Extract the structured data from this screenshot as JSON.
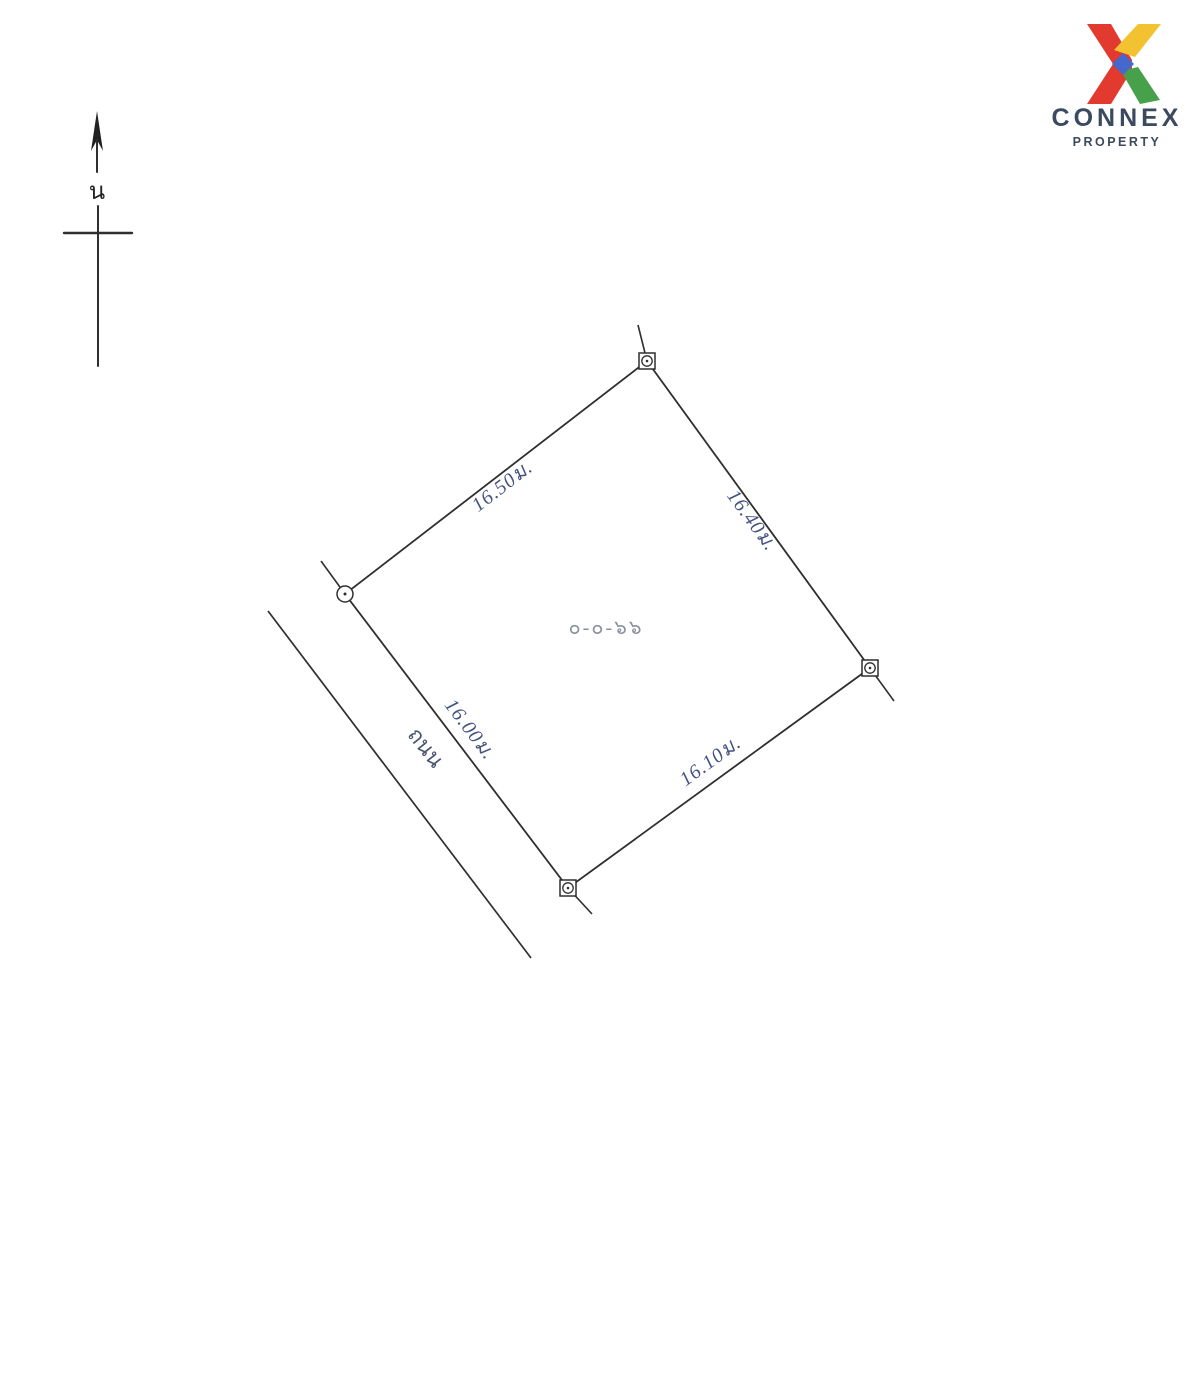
{
  "logo": {
    "brand": "CONNEX",
    "tagline": "PROPERTY",
    "colors": {
      "red": "#e23a2e",
      "yellow": "#f2c230",
      "green": "#47a14b",
      "blue": "#4468cc",
      "text": "#3b4a5e"
    }
  },
  "compass": {
    "north_label": "น"
  },
  "survey": {
    "area_label": "๐-๐-๖๖",
    "road_label": "ถนน",
    "dimensions": {
      "northwest": "16.50ม.",
      "northeast": "16.40ม.",
      "southwest": "16.00ม.",
      "southeast": "16.10ม."
    },
    "dimension_color": "#455380",
    "area_color": "#8a8fa0",
    "road_color": "#4a5570",
    "line_color": "#2f2f2f"
  }
}
